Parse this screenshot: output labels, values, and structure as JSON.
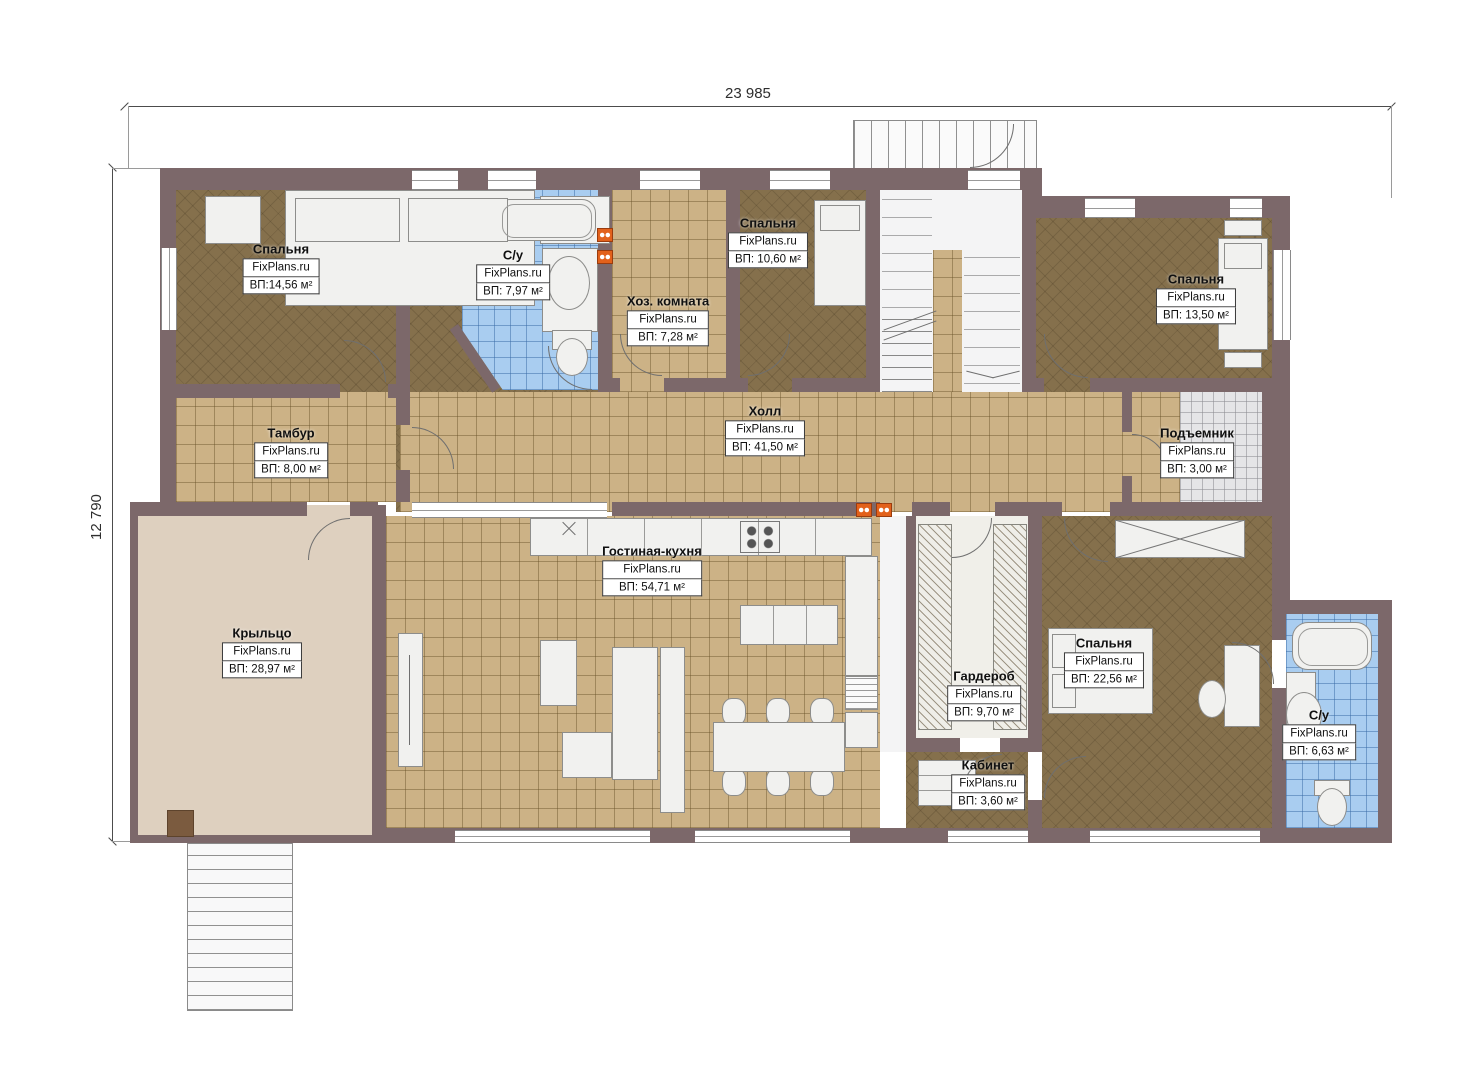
{
  "watermark": "FixPlans.ru",
  "dimensions": {
    "width_label": "23 985",
    "height_label": "12 790"
  },
  "rooms": [
    {
      "key": "bedroom1",
      "name": "Спальня",
      "area": "ВП:14,56 м²"
    },
    {
      "key": "bath1",
      "name": "С/у",
      "area": "ВП: 7,97 м²"
    },
    {
      "key": "utility",
      "name": "Хоз. комната",
      "area": "ВП: 7,28 м²"
    },
    {
      "key": "bedroom2",
      "name": "Спальня",
      "area": "ВП: 10,60 м²"
    },
    {
      "key": "bedroom3",
      "name": "Спальня",
      "area": "ВП: 13,50 м²"
    },
    {
      "key": "tambour",
      "name": "Тамбур",
      "area": "ВП: 8,00 м²"
    },
    {
      "key": "hall",
      "name": "Холл",
      "area": "ВП: 41,50 м²"
    },
    {
      "key": "lift",
      "name": "Подъемник",
      "area": "ВП: 3,00 м²"
    },
    {
      "key": "porch",
      "name": "Крыльцо",
      "area": "ВП: 28,97 м²"
    },
    {
      "key": "living",
      "name": "Гостиная-кухня",
      "area": "ВП: 54,71 м²"
    },
    {
      "key": "wardrobe",
      "name": "Гардероб",
      "area": "ВП: 9,70 м²"
    },
    {
      "key": "bedroom4",
      "name": "Спальня",
      "area": "ВП: 22,56 м²"
    },
    {
      "key": "cabinet",
      "name": "Кабинет",
      "area": "ВП: 3,60 м²"
    },
    {
      "key": "bath2",
      "name": "С/у",
      "area": "ВП: 6,63 м²"
    }
  ],
  "colors": {
    "wall": "#7c686a",
    "tile": "#ccb286",
    "bed": "#85704c",
    "bath": "#a9cdf0",
    "porch": "#ded0bf",
    "lift": "#e5e5e7",
    "furn": "#f1f1ef",
    "rad": "#e2611b",
    "stair": "#f5f5f6"
  }
}
